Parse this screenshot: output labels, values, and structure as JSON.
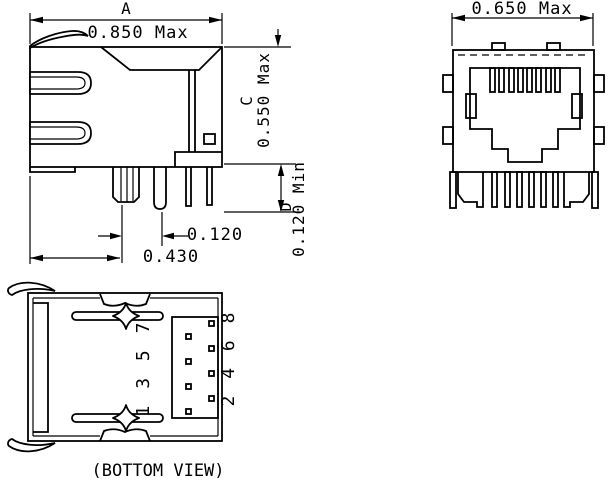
{
  "colors": {
    "line": "#000000",
    "background": "#ffffff"
  },
  "side_view": {
    "dim_a_letter": "A",
    "dim_a_value": "0.850 Max",
    "dim_c_letter": "C",
    "dim_c_value": "0.550 Max",
    "dim_d_letter": "D",
    "dim_d_value": "0.120 Min",
    "dim_pin_to_post": "0.120",
    "dim_edge_to_post": "0.430"
  },
  "front_view": {
    "dim_width": "0.650 Max"
  },
  "bottom_view": {
    "caption": "(BOTTOM VIEW)",
    "odd_pin_labels": "1 3 5 7",
    "even_pin_labels": "2 4 6 8"
  }
}
